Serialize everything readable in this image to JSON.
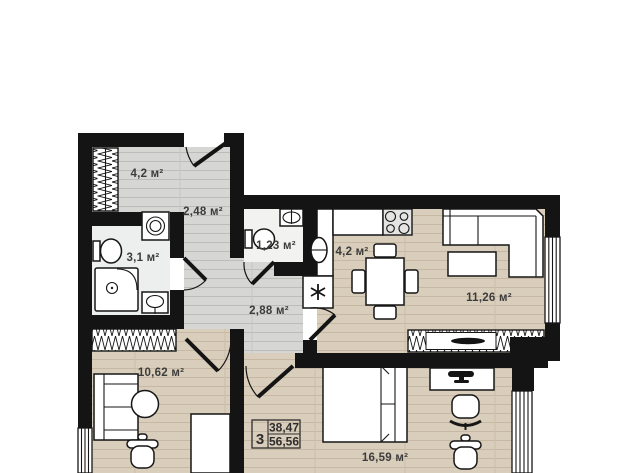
{
  "plan": {
    "apartment_stats": {
      "rooms_count": "3",
      "area_upper": "38,47",
      "area_lower": "56,56"
    },
    "rooms": {
      "wardrobe_top": {
        "area_label": "4,2 м²"
      },
      "hallway_entry": {
        "area_label": "2,48 м²"
      },
      "bathroom": {
        "area_label": "3,1 м²"
      },
      "wc": {
        "area_label": "1,23 м²"
      },
      "kitchen": {
        "area_label": "4,2 м²"
      },
      "living_room": {
        "area_label": "11,26 м²"
      },
      "hallway_inner": {
        "area_label": "2,88 м²"
      },
      "bedroom_small": {
        "area_label": "10,62 м²"
      },
      "bedroom_main": {
        "area_label": "16,59 м²"
      }
    },
    "colors": {
      "wall": "#141414",
      "wood_floor": "#d9cdbb",
      "laminate_floor": "#d6d6d4",
      "tile_floor": "#edefee",
      "wc_floor": "#f2f3f1",
      "label_text": "#3c3c3c",
      "background": "#ffffff"
    }
  }
}
